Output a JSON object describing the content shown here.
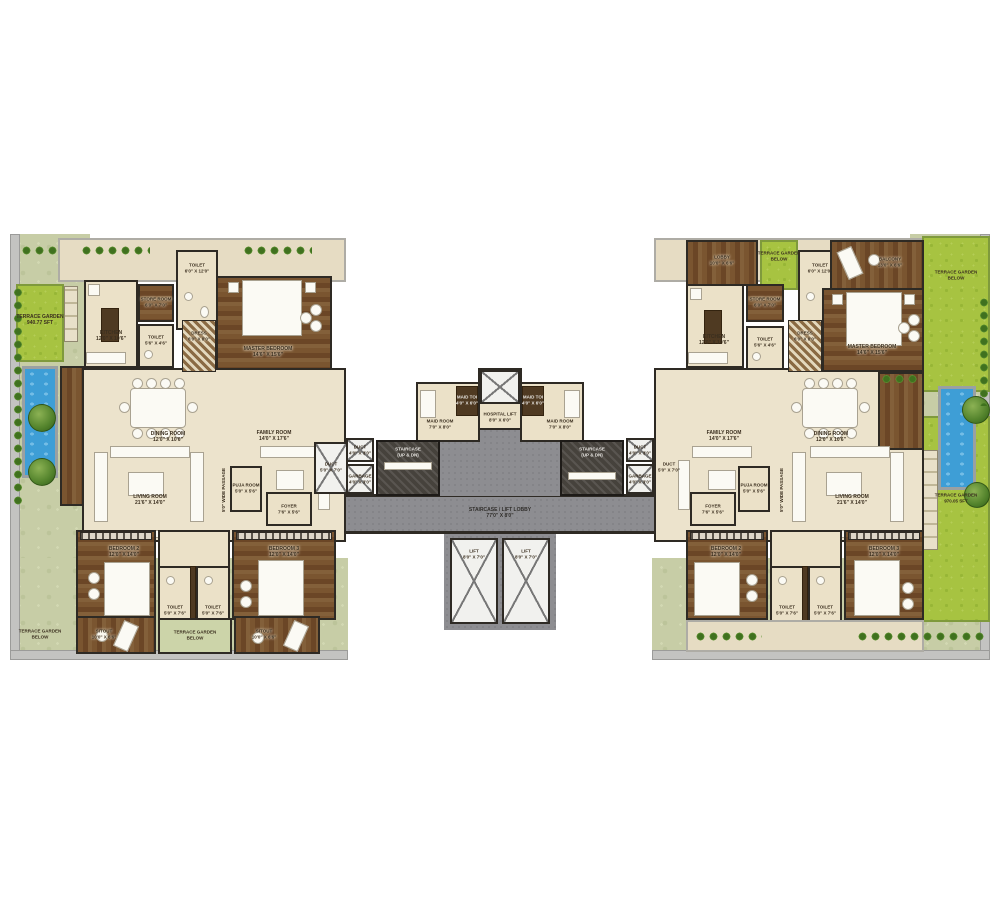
{
  "left": {
    "garden": {
      "t": "TERRACE GARDEN",
      "d": "940.77 SFT"
    },
    "kitchen": {
      "t": "KITCHEN",
      "d": "12'0\" X 10'6\""
    },
    "store": {
      "t": "STORE ROOM",
      "d": "6'0\" X 7'0\""
    },
    "toilet_top": {
      "t": "TOILET",
      "d": "6'0\" X 12'0\""
    },
    "toilet_mid": {
      "t": "TOILET",
      "d": "5'6\" X 4'6\""
    },
    "dress": {
      "t": "DRESS",
      "d": "6'0\" X 8'0\""
    },
    "master": {
      "t": "MASTER BEDROOM",
      "d": "14'6\" X 15'6\""
    },
    "dining": {
      "t": "DINING ROOM",
      "d": "12'0\" X 10'6\""
    },
    "living": {
      "t": "LIVING ROOM",
      "d": "21'6\" X 14'0\""
    },
    "family": {
      "t": "FAMILY ROOM",
      "d": "14'0\" X 17'6\""
    },
    "puja": {
      "t": "PUJA ROOM",
      "d": "5'0\" X 5'6\""
    },
    "foyer": {
      "t": "FOYER",
      "d": "7'6\" X 5'6\""
    },
    "passage": {
      "t": "5'0\" WIDE PASSAGE"
    },
    "duct": {
      "t": "DUCT",
      "d": "5'0\" X 7'0\""
    },
    "bed2": {
      "t": "BEDROOM 2",
      "d": "12'0\" X 14'0\""
    },
    "bed3": {
      "t": "BEDROOM 3",
      "d": "12'0\" X 14'0\""
    },
    "toilet_b1": {
      "t": "TOILET",
      "d": "5'0\" X 7'6\""
    },
    "toilet_b2": {
      "t": "TOILET",
      "d": "5'0\" X 7'6\""
    },
    "sitout1": {
      "t": "SITOUT",
      "d": "10'0\" X 6'6\""
    },
    "sitout2": {
      "t": "SITOUT",
      "d": "10'0\" X 6'6\""
    },
    "terrace_mid": {
      "t": "TERRACE GARDEN",
      "d": "BELOW"
    },
    "terrace_corner": {
      "t": "TERRACE GARDEN",
      "d": "BELOW"
    }
  },
  "core": {
    "maid_l": {
      "t": "MAID ROOM",
      "d": "7'0\" X 8'0\""
    },
    "maid_toi_l": {
      "t": "MAID TOI",
      "d": "4'0\" X 6'0\""
    },
    "hospital_lift": {
      "t": "HOSPITAL LIFT",
      "d": "8'0\" X 6'0\""
    },
    "maid_r": {
      "t": "MAID ROOM",
      "d": "7'0\" X 8'0\""
    },
    "maid_toi_r": {
      "t": "MAID TOI",
      "d": "4'0\" X 6'0\""
    },
    "stair_l": {
      "t": "STAIRCASE",
      "d": "(UP & DN)"
    },
    "stair_r": {
      "t": "STAIRCASE",
      "d": "(UP & DN)"
    },
    "duct_l": {
      "t": "DUCT",
      "d": "4'0\" X 3'0\""
    },
    "garbage_l": {
      "t": "GARBAGE",
      "d": "4'0\" X 3'0\""
    },
    "duct_r": {
      "t": "DUCT",
      "d": "4'0\" X 3'0\""
    },
    "garbage_r": {
      "t": "GARBAGE",
      "d": "4'0\" X 3'0\""
    },
    "lobby": {
      "t": "STAIRCASE / LIFT LOBBY",
      "d": "77'0\" X 8'0\""
    },
    "lift1": {
      "t": "LIFT",
      "d": "8'0\" X 7'0\""
    },
    "lift2": {
      "t": "LIFT",
      "d": "8'0\" X 7'0\""
    }
  },
  "right": {
    "lobby_room": {
      "t": "LOBBY",
      "d": "10'0\" X 6'6\""
    },
    "terrace_top": {
      "t": "TERRACE GARDEN",
      "d": "BELOW"
    },
    "toilet_top": {
      "t": "TOILET",
      "d": "6'0\" X 12'0\""
    },
    "balcony": {
      "t": "BALCONY",
      "d": "13'0\" X 6'6\""
    },
    "terrace_right": {
      "t": "TERRACE GARDEN",
      "d": "BELOW"
    },
    "garden": {
      "t": "TERRACE GARDEN",
      "d": "970.05 SFT"
    },
    "kitchen": {
      "t": "KITCHEN",
      "d": "12'0\" X 10'6\""
    },
    "store": {
      "t": "STORE ROOM",
      "d": "6'0\" X 7'0\""
    },
    "toilet_mid": {
      "t": "TOILET",
      "d": "5'6\" X 4'6\""
    },
    "dress": {
      "t": "DRESS",
      "d": "6'0\" X 8'0\""
    },
    "master": {
      "t": "MASTER BEDROOM",
      "d": "14'6\" X 15'6\""
    },
    "dining": {
      "t": "DINING ROOM",
      "d": "12'0\" X 10'6\""
    },
    "living": {
      "t": "LIVING ROOM",
      "d": "21'6\" X 14'0\""
    },
    "family": {
      "t": "FAMILY ROOM",
      "d": "14'0\" X 17'6\""
    },
    "puja": {
      "t": "PUJA ROOM",
      "d": "5'0\" X 5'6\""
    },
    "foyer": {
      "t": "FOYER",
      "d": "7'6\" X 5'6\""
    },
    "passage": {
      "t": "5'0\" WIDE PASSAGE"
    },
    "duct": {
      "t": "DUCT",
      "d": "5'0\" X 7'0\""
    },
    "bed2": {
      "t": "BEDROOM 2",
      "d": "12'0\" X 14'0\""
    },
    "bed3": {
      "t": "BEDROOM 3",
      "d": "12'0\" X 14'0\""
    },
    "toilet_b1": {
      "t": "TOILET",
      "d": "5'0\" X 7'6\""
    },
    "toilet_b2": {
      "t": "TOILET",
      "d": "5'0\" X 7'6\""
    }
  }
}
